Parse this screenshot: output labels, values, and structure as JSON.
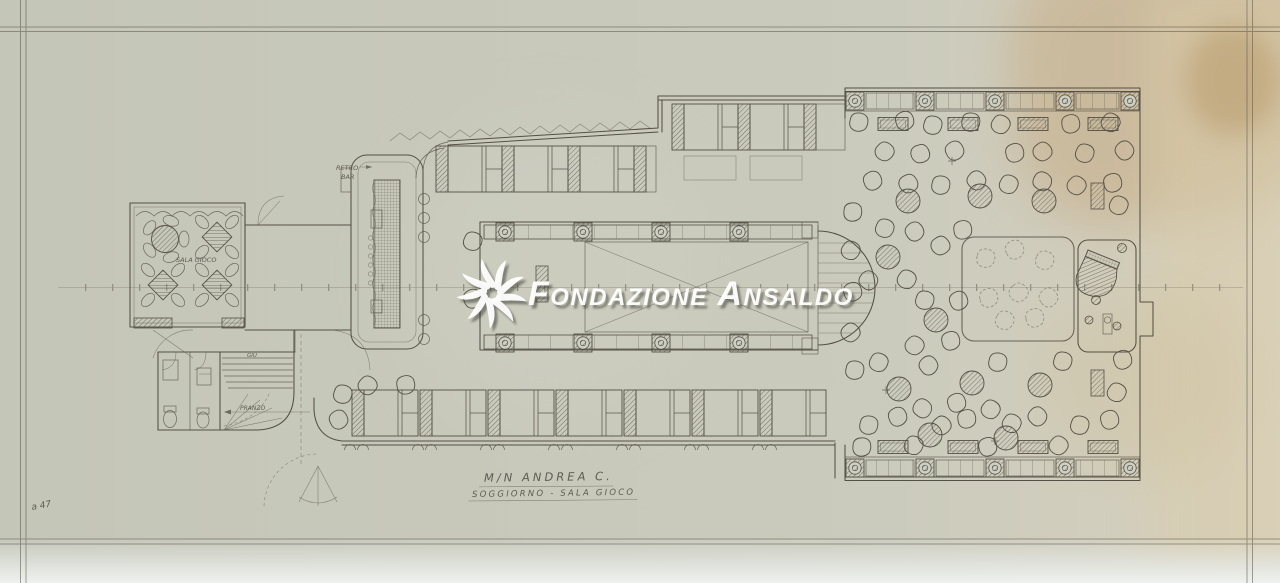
{
  "sheet": {
    "description": "Scanned pencil deck plan of motor ship, lounge and game room",
    "colors": {
      "paper": "#c8c9bb",
      "paper_right": "#d8d3c2",
      "stain": "#c5a87e",
      "pencil_ink": "#545045",
      "watermark": "#ffffff"
    }
  },
  "watermark": {
    "logo": "pinwheel-icon",
    "text": "Fondazione Ansaldo"
  },
  "title_block": {
    "ship_name": "M/N ANDREA C.",
    "drawing_title": "SOGGIORNO - SALA GIOCO"
  },
  "room_labels": {
    "game_room": "SALA GIOCO",
    "bar_line1": "RETRO",
    "bar_line2": "BAR",
    "stairs_down": "GIÙ",
    "stairs_destination": "PRANZO"
  },
  "annotations": {
    "corner_mark": "a 47"
  }
}
